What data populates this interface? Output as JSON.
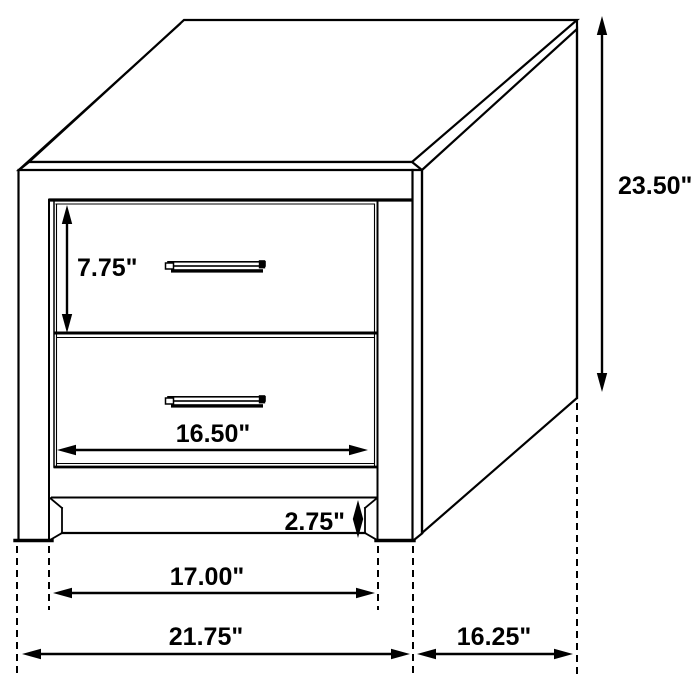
{
  "page": {
    "background_color": "#ffffff",
    "line_color": "#000000",
    "label_color": "#000000"
  },
  "diagram": {
    "type": "furniture-dimension-diagram",
    "subject": "two-drawer nightstand line drawing, three-quarter view with dimension arrows",
    "dimensions": {
      "overall_height": "23.50\"",
      "drawer_height": "7.75\"",
      "drawer_width": "16.50\"",
      "base_rail_height": "2.75\"",
      "leg_to_leg_width": "17.00\"",
      "overall_width": "21.75\"",
      "depth": "16.25\""
    }
  }
}
